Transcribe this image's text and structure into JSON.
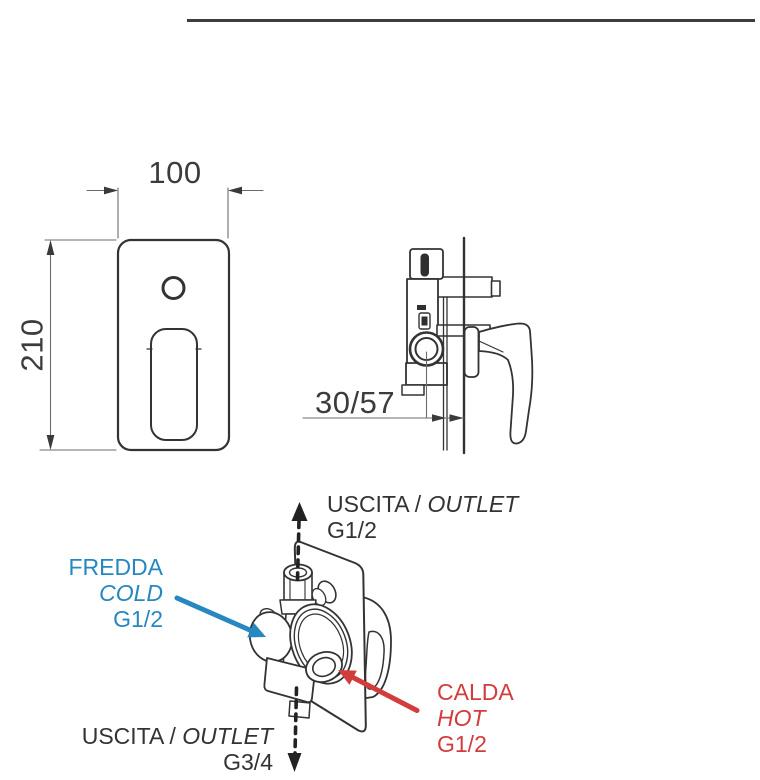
{
  "colors": {
    "cold_blue": "#2787c0",
    "hot_red": "#d23c3c",
    "ink": "#383838",
    "line": "#333333"
  },
  "front_view": {
    "width_dim": "100",
    "height_dim": "210"
  },
  "side_view": {
    "depth_dim": "30/57"
  },
  "perspective_view": {
    "outlet_top": {
      "label": "USCITA /",
      "label_italic": "OUTLET",
      "thread": "G1/2"
    },
    "cold": {
      "label_it": "FREDDA",
      "label_en": "COLD",
      "thread": "G1/2"
    },
    "hot": {
      "label_it": "CALDA",
      "label_en": "HOT",
      "thread": "G1/2"
    },
    "outlet_bottom": {
      "label": "USCITA /",
      "label_italic": "OUTLET",
      "thread": "G3/4"
    }
  }
}
